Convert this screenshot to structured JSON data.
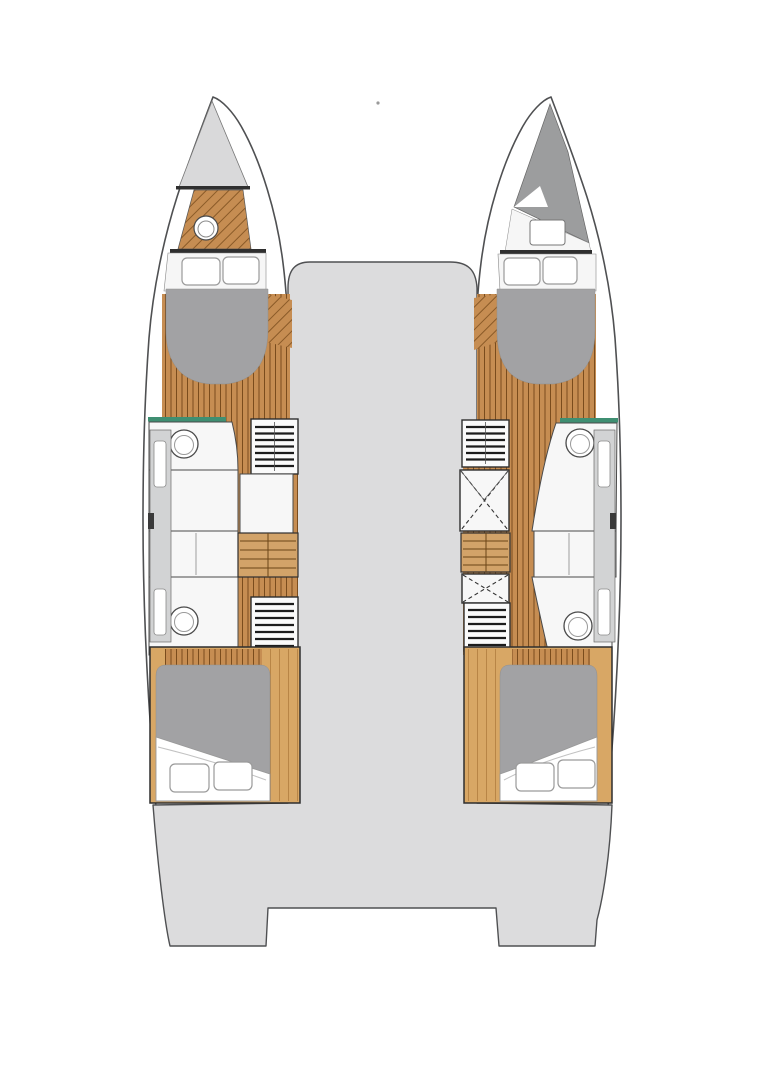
{
  "image": {
    "kind": "boat-floorplan",
    "view": "top-down",
    "description": "Catamaran interior layout plan with two hulls, central bridgedeck and twin transom steps"
  },
  "colors": {
    "background": "#ffffff",
    "deck": "#dcdcdd",
    "outline": "#4f5052",
    "hull": "#ffffff",
    "wall": "#2f2f2f",
    "wood": "#c68d52",
    "wood_line": "#7a4c1d",
    "wood_light": "#d8a765",
    "stairs": "#d2a369",
    "mattress": "#a2a2a4",
    "forepeak_gray": "#9c9d9e",
    "anchor_locker": "#d9d9da",
    "locker_panel": "#d2d3d4",
    "room": "#f7f7f7",
    "shower_screen": "#3f8f72",
    "pillow": "#ffffff"
  },
  "port_hull": {
    "side": "port",
    "components": [
      "anchor-locker",
      "forepeak-wc",
      "forward-berth-pillows",
      "forward-double-berth",
      "shower-screen",
      "forward-bathroom",
      "hull-lockers",
      "forward-wardrobe",
      "shower-compartment",
      "staircase",
      "aft-bathroom",
      "aft-wardrobe",
      "aft-double-berth"
    ]
  },
  "starboard_hull": {
    "side": "starboard",
    "components": [
      "forepeak-locker",
      "bow-hatch",
      "forward-berth-pillows",
      "forward-double-berth",
      "shower-screen",
      "forward-bathroom",
      "hull-lockers",
      "forward-wardrobe",
      "technical-locker-x",
      "staircase",
      "technical-locker-x-aft",
      "aft-wardrobe",
      "aft-bathroom",
      "aft-double-berth"
    ]
  },
  "deck": {
    "components": [
      "bridgedeck",
      "aft-cockpit",
      "port-transom-steps",
      "starboard-transom-steps",
      "stern-recess"
    ]
  },
  "berths": {
    "count": 4,
    "pillows_per_berth": 2
  },
  "bathrooms": {
    "count": 4
  },
  "staircases": {
    "count": 2
  }
}
